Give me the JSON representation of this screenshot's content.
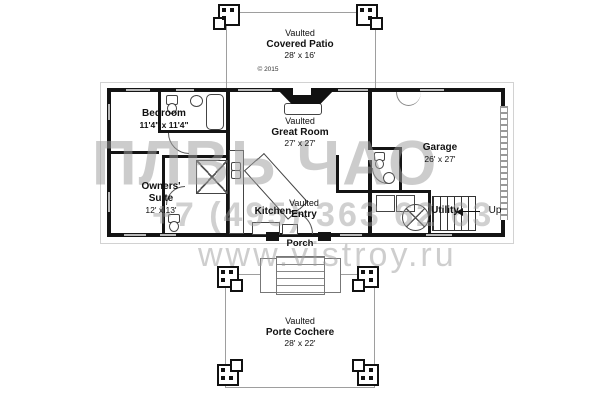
{
  "copyright": "© 2015",
  "rooms": {
    "covered_patio": {
      "prefix": "Vaulted",
      "name": "Covered Patio",
      "dims": "28' x 16'"
    },
    "bedroom": {
      "name": "Bedroom",
      "dims": "11'4\" x 11'4\""
    },
    "great_room": {
      "prefix": "Vaulted",
      "name": "Great Room",
      "dims": "27' x 27'"
    },
    "garage": {
      "name": "Garage",
      "dims": "26' x 27'"
    },
    "owners_suite": {
      "name_line1": "Owners'",
      "name_line2": "Suite",
      "dims": "12' x 13'"
    },
    "kitchen": {
      "name": "Kitchen"
    },
    "entry": {
      "prefix": "Vaulted",
      "name": "Entry"
    },
    "utility": {
      "name": "Utility"
    },
    "stairs": {
      "label": "Up"
    },
    "porch": {
      "name": "Porch"
    },
    "porte_cochere": {
      "prefix": "Vaulted",
      "name": "Porte Cochere",
      "dims": "28' x 22'"
    }
  },
  "watermark": {
    "logo": "ПЛВЬ ЧАО",
    "phone": "+7 (495) 363 62 63",
    "site": "www.vistroy.ru"
  },
  "colors": {
    "wall": "#141414",
    "watermark": "#9f9f9f",
    "outline": "#9e9e9e",
    "window": "#b9b9b9"
  }
}
